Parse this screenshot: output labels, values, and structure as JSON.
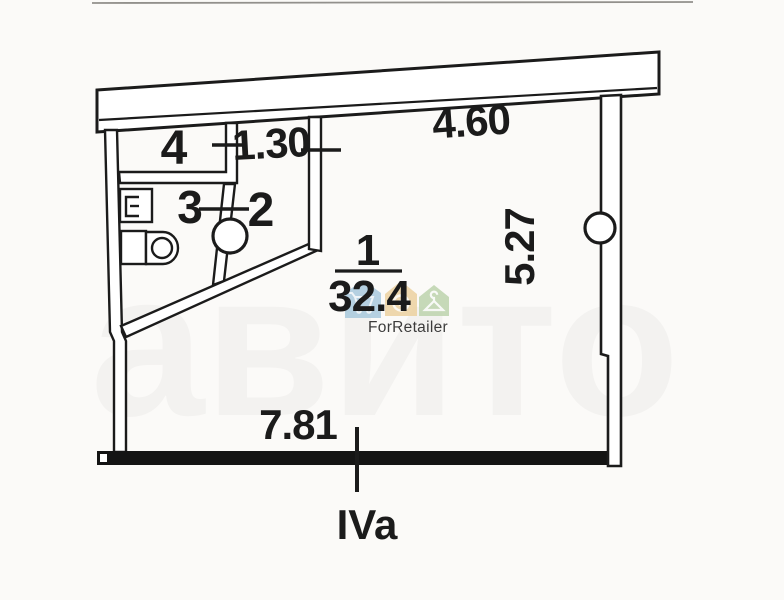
{
  "title": "apartment floor plan scan",
  "plan": {
    "rooms": [
      {
        "number": "1",
        "area": "32.4"
      },
      {
        "number": "2"
      },
      {
        "number": "3"
      },
      {
        "number": "4"
      }
    ],
    "dimensions": {
      "top_wall": "4.60",
      "room2_width": "1.30",
      "right_wall": "5.27",
      "bottom_wall": "7.81"
    },
    "section_label": "IVa",
    "colors": {
      "ink": "#1b1b1b",
      "section_label": "#d84b33",
      "paper": "#fbfaf8"
    }
  },
  "watermark": {
    "brand": "ForRetailer",
    "brand_color": "#a5a5a5",
    "ghost": "авито",
    "houses": [
      {
        "name": "house-cart",
        "color": "#a9c9dd"
      },
      {
        "name": "house-ring",
        "color": "#ecd2a0"
      },
      {
        "name": "house-hanger",
        "color": "#bdd4ae"
      }
    ]
  }
}
